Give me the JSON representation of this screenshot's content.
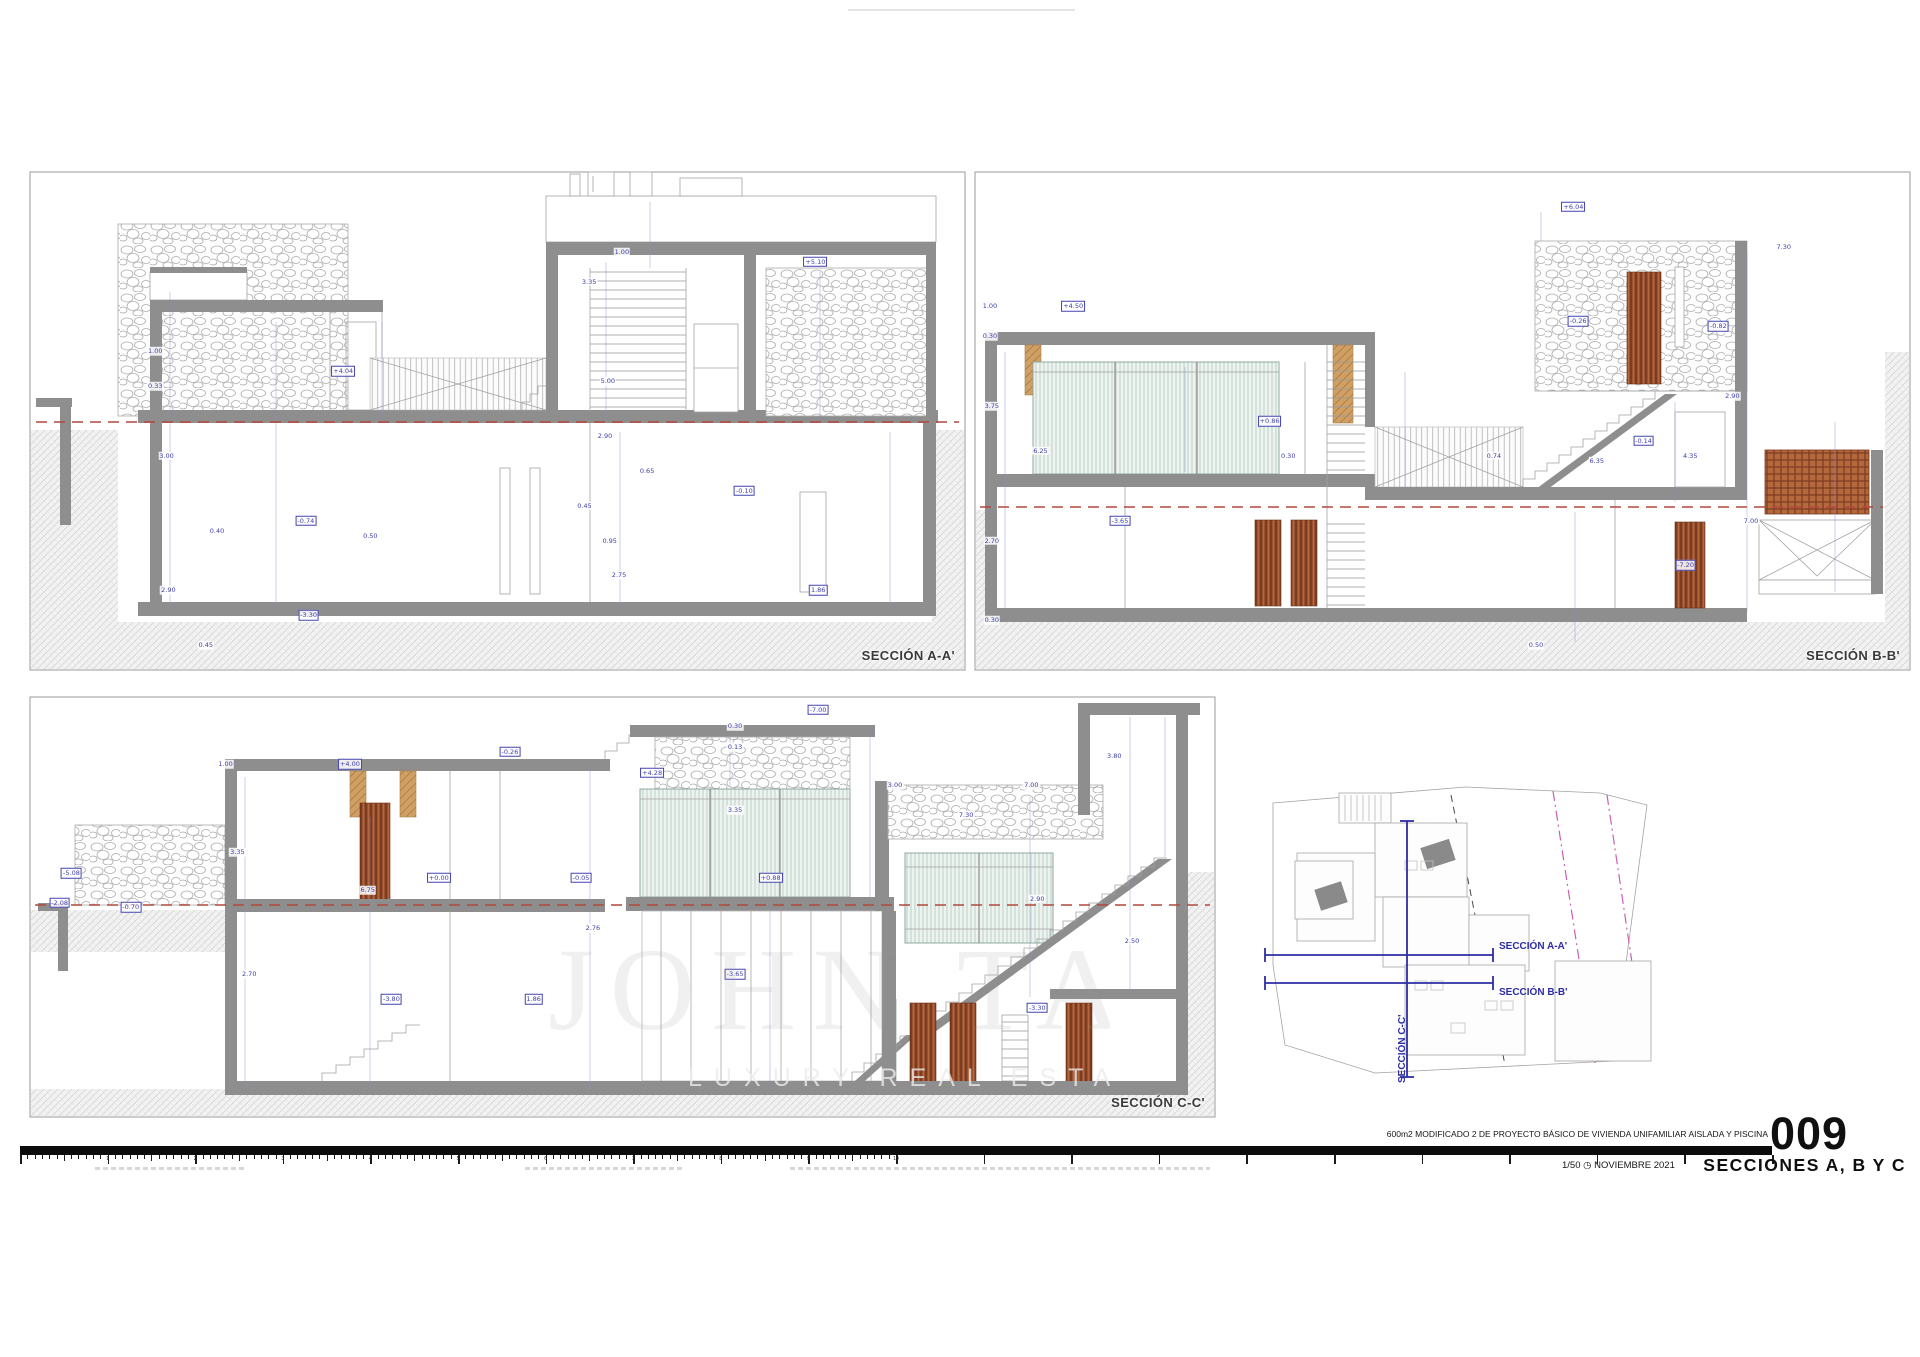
{
  "meta": {
    "project": "600m2   MODIFICADO 2 DE PROYECTO BÁSICO DE VIVIENDA UNIFAMILIAR AISLADA Y PISCINA",
    "sheet_number": "009",
    "sheet_title": "SECCIONES A, B Y C",
    "scale": "1/50",
    "date": "NOVIEMBRE 2021"
  },
  "icons": {
    "compass": "◷"
  },
  "watermark": {
    "title": "JOHN TAYLOR",
    "subtitle": "LUXURY REAL ESTATE SIN"
  },
  "sections": [
    {
      "id": "A",
      "label": "SECCIÓN A-A'",
      "dims": [
        {
          "v": "1.00",
          "x": 13.4,
          "y": 36
        },
        {
          "v": "0.33",
          "x": 13.4,
          "y": 43
        },
        {
          "v": "+4.04",
          "x": 33.5,
          "y": 40,
          "b": 1
        },
        {
          "v": "3.00",
          "x": 14.6,
          "y": 57
        },
        {
          "v": "0.40",
          "x": 20.0,
          "y": 72
        },
        {
          "v": "-0.74",
          "x": 29.5,
          "y": 70,
          "b": 1
        },
        {
          "v": "0.50",
          "x": 36.4,
          "y": 73
        },
        {
          "v": "2.90",
          "x": 14.8,
          "y": 84
        },
        {
          "v": "-3.30",
          "x": 29.8,
          "y": 89,
          "b": 1
        },
        {
          "v": "3.35",
          "x": 59.8,
          "y": 22
        },
        {
          "v": "1.00",
          "x": 63.3,
          "y": 16
        },
        {
          "v": "+5.10",
          "x": 84.0,
          "y": 18,
          "b": 1
        },
        {
          "v": "5.00",
          "x": 61.8,
          "y": 42
        },
        {
          "v": "2.90",
          "x": 61.5,
          "y": 53
        },
        {
          "v": "0.65",
          "x": 66.0,
          "y": 60
        },
        {
          "v": "0.45",
          "x": 59.3,
          "y": 67
        },
        {
          "v": "-0.10",
          "x": 76.4,
          "y": 64,
          "b": 1
        },
        {
          "v": "0.95",
          "x": 62.0,
          "y": 74
        },
        {
          "v": "2.75",
          "x": 63.0,
          "y": 81
        },
        {
          "v": "1.86",
          "x": 84.3,
          "y": 84,
          "b": 1
        },
        {
          "v": "0.45",
          "x": 18.8,
          "y": 95
        }
      ]
    },
    {
      "id": "B",
      "label": "SECCIÓN B-B'",
      "dims": [
        {
          "v": "+6.04",
          "x": 64.0,
          "y": 7,
          "b": 1
        },
        {
          "v": "+4.50",
          "x": 10.5,
          "y": 27,
          "b": 1
        },
        {
          "v": "1.00",
          "x": 1.6,
          "y": 27
        },
        {
          "v": "0.30",
          "x": 1.6,
          "y": 33
        },
        {
          "v": "3.75",
          "x": 1.8,
          "y": 47
        },
        {
          "v": "-0.26",
          "x": 64.5,
          "y": 30,
          "b": 1
        },
        {
          "v": "-0.82",
          "x": 79.5,
          "y": 31,
          "b": 1
        },
        {
          "v": "+0.86",
          "x": 31.5,
          "y": 50,
          "b": 1
        },
        {
          "v": "6.25",
          "x": 7.0,
          "y": 56
        },
        {
          "v": "-0.14",
          "x": 71.5,
          "y": 54,
          "b": 1
        },
        {
          "v": "4.35",
          "x": 76.5,
          "y": 57
        },
        {
          "v": "2.90",
          "x": 81.0,
          "y": 45
        },
        {
          "v": "0.30",
          "x": 33.5,
          "y": 57
        },
        {
          "v": "0.74",
          "x": 55.5,
          "y": 57
        },
        {
          "v": "2.70",
          "x": 1.8,
          "y": 74
        },
        {
          "v": "-3.65",
          "x": 15.5,
          "y": 70,
          "b": 1
        },
        {
          "v": "7.30",
          "x": 86.5,
          "y": 15
        },
        {
          "v": "7.00",
          "x": 83.0,
          "y": 70
        },
        {
          "v": "-7.20",
          "x": 76.0,
          "y": 79,
          "b": 1
        },
        {
          "v": "0.50",
          "x": 60.0,
          "y": 95
        },
        {
          "v": "0.30",
          "x": 1.8,
          "y": 90
        },
        {
          "v": "6.35",
          "x": 66.5,
          "y": 58
        }
      ]
    },
    {
      "id": "C",
      "label": "SECCIÓN C-C'",
      "dims": [
        {
          "v": "-7.00",
          "x": 66.5,
          "y": 3,
          "b": 1
        },
        {
          "v": "0.30",
          "x": 59.5,
          "y": 7
        },
        {
          "v": "0.13",
          "x": 59.5,
          "y": 12
        },
        {
          "v": "+4.00",
          "x": 27.0,
          "y": 16,
          "b": 1
        },
        {
          "v": "1.00",
          "x": 16.5,
          "y": 16
        },
        {
          "v": "-0.26",
          "x": 40.5,
          "y": 13,
          "b": 1
        },
        {
          "v": "+4.28",
          "x": 52.5,
          "y": 18,
          "b": 1
        },
        {
          "v": "3.35",
          "x": 59.5,
          "y": 27
        },
        {
          "v": "3.00",
          "x": 73.0,
          "y": 21
        },
        {
          "v": "7.00",
          "x": 84.5,
          "y": 21
        },
        {
          "v": "3.80",
          "x": 91.5,
          "y": 14
        },
        {
          "v": "3.35",
          "x": 17.5,
          "y": 37
        },
        {
          "v": "+0.00",
          "x": 34.5,
          "y": 43,
          "b": 1
        },
        {
          "v": "-0.05",
          "x": 46.5,
          "y": 43,
          "b": 1
        },
        {
          "v": "+0.88",
          "x": 62.5,
          "y": 43,
          "b": 1
        },
        {
          "v": "6.75",
          "x": 28.5,
          "y": 46
        },
        {
          "v": "-2.08",
          "x": 2.5,
          "y": 49,
          "b": 1
        },
        {
          "v": "-0.70",
          "x": 8.5,
          "y": 50,
          "b": 1
        },
        {
          "v": "7.30",
          "x": 79.0,
          "y": 28
        },
        {
          "v": "2.90",
          "x": 85.0,
          "y": 48
        },
        {
          "v": "2.76",
          "x": 47.5,
          "y": 55
        },
        {
          "v": "2.70",
          "x": 18.5,
          "y": 66
        },
        {
          "v": "-3.80",
          "x": 30.5,
          "y": 72,
          "b": 1
        },
        {
          "v": "1.86",
          "x": 42.5,
          "y": 72,
          "b": 1
        },
        {
          "v": "-3.65",
          "x": 59.5,
          "y": 66,
          "b": 1
        },
        {
          "v": "2.50",
          "x": 93.0,
          "y": 58
        },
        {
          "v": "-3.30",
          "x": 85.0,
          "y": 74,
          "b": 1
        },
        {
          "v": "-5.08",
          "x": 3.5,
          "y": 42,
          "b": 1
        }
      ]
    }
  ],
  "siteplan": {
    "labels": [
      {
        "text": "SECCIÓN A-A'"
      },
      {
        "text": "SECCIÓN B-B'"
      },
      {
        "text": "SECCIÓN C-C'"
      }
    ]
  },
  "ruler": {
    "labels": [
      "1",
      "2",
      "3",
      "4",
      "5",
      "6",
      "7",
      "8",
      "9",
      "10"
    ]
  }
}
